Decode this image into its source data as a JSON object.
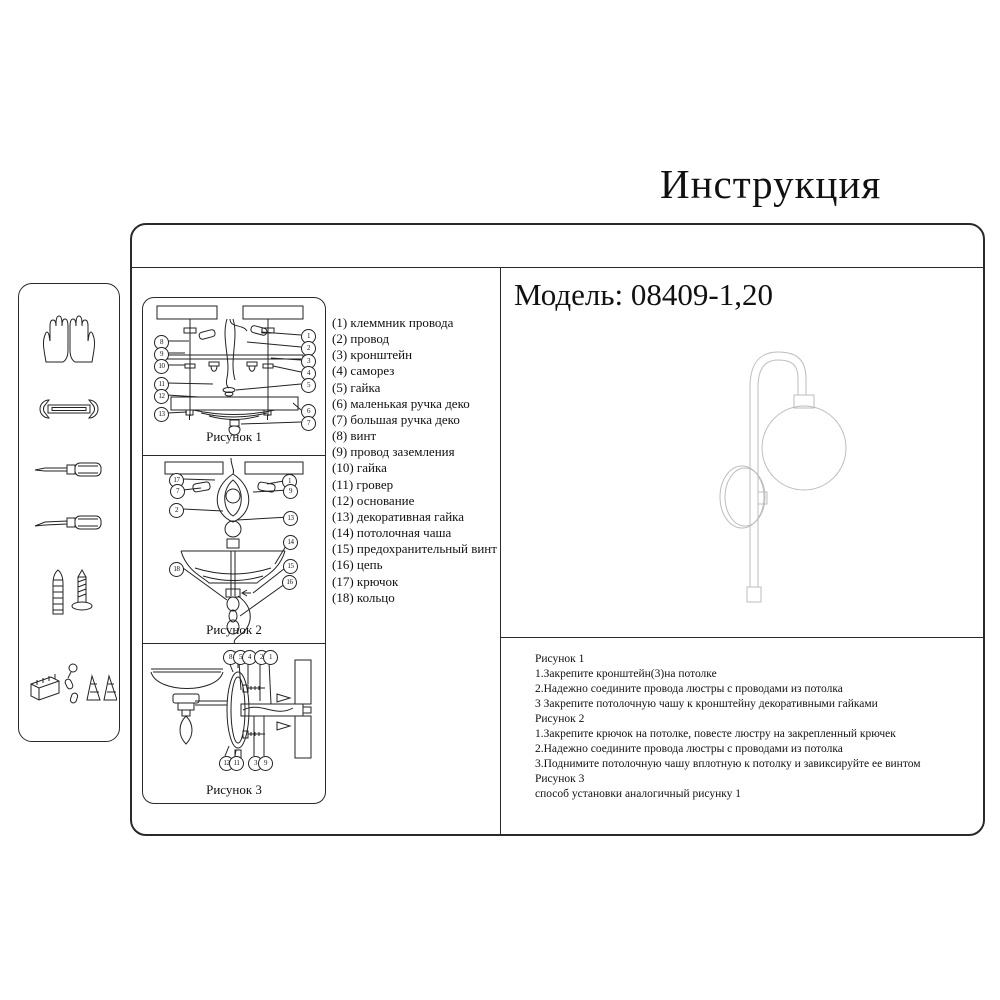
{
  "title": "Инструкция",
  "model_label": "Модель: 08409-1,20",
  "figures": [
    {
      "caption": "Рисунок 1",
      "left_callouts": [
        "8",
        "9",
        "10",
        "11",
        "12",
        "13"
      ],
      "right_callouts": [
        "1",
        "2",
        "3",
        "4",
        "5",
        "6",
        "7"
      ]
    },
    {
      "caption": "Рисунок 2",
      "left_callouts": [
        "17",
        "7",
        "2",
        "18"
      ],
      "right_callouts": [
        "1",
        "9",
        "13",
        "14",
        "15",
        "16"
      ]
    },
    {
      "caption": "Рисунок 3",
      "top_callouts": [
        "8",
        "5",
        "4",
        "2",
        "1"
      ],
      "bottom_callouts": [
        "12",
        "11",
        "3",
        "9"
      ]
    }
  ],
  "parts": {
    "items": [
      "(1) клеммник провода",
      "(2) провод",
      "(3) кронштейн",
      "(4) саморез",
      "(5) гайка",
      "(6) маленькая ручка деко",
      "(7) большая ручка деко",
      "(8) винт",
      "(9) провод заземления",
      "(10) гайка",
      "(11) гровер",
      "(12) основание",
      "(13) декоративная гайка",
      "(14) потолочная чаша",
      "(15) предохранительный винт",
      "(16) цепь",
      "(17) крючок",
      "(18) кольцо"
    ]
  },
  "instructions": {
    "lines": [
      "Рисунок 1",
      "1.Закрепите кронштейн(3)на потолке",
      "2.Надежно соедините провода люстры с проводами из потолка",
      "3 Закрепите потолочную чашу к кронштейну декоративными гайками",
      "Рисунок 2",
      "1.Закрепите крючок на потолке, повесте люстру на закрепленный крючек",
      "2.Надежно соедините провода люстры с проводами из потолка",
      "3.Поднимите потолочную чашу вплотную к потолку и завиксируйте ее винтом",
      "Рисунок 3",
      "способ установки аналогичный рисунку 1"
    ]
  },
  "tools": {
    "icons": [
      "gloves-icon",
      "wrench-icon",
      "screwdriver-icon",
      "screwdriver-icon",
      "anchor-screw-icon",
      "hardware-parts-icon"
    ]
  }
}
